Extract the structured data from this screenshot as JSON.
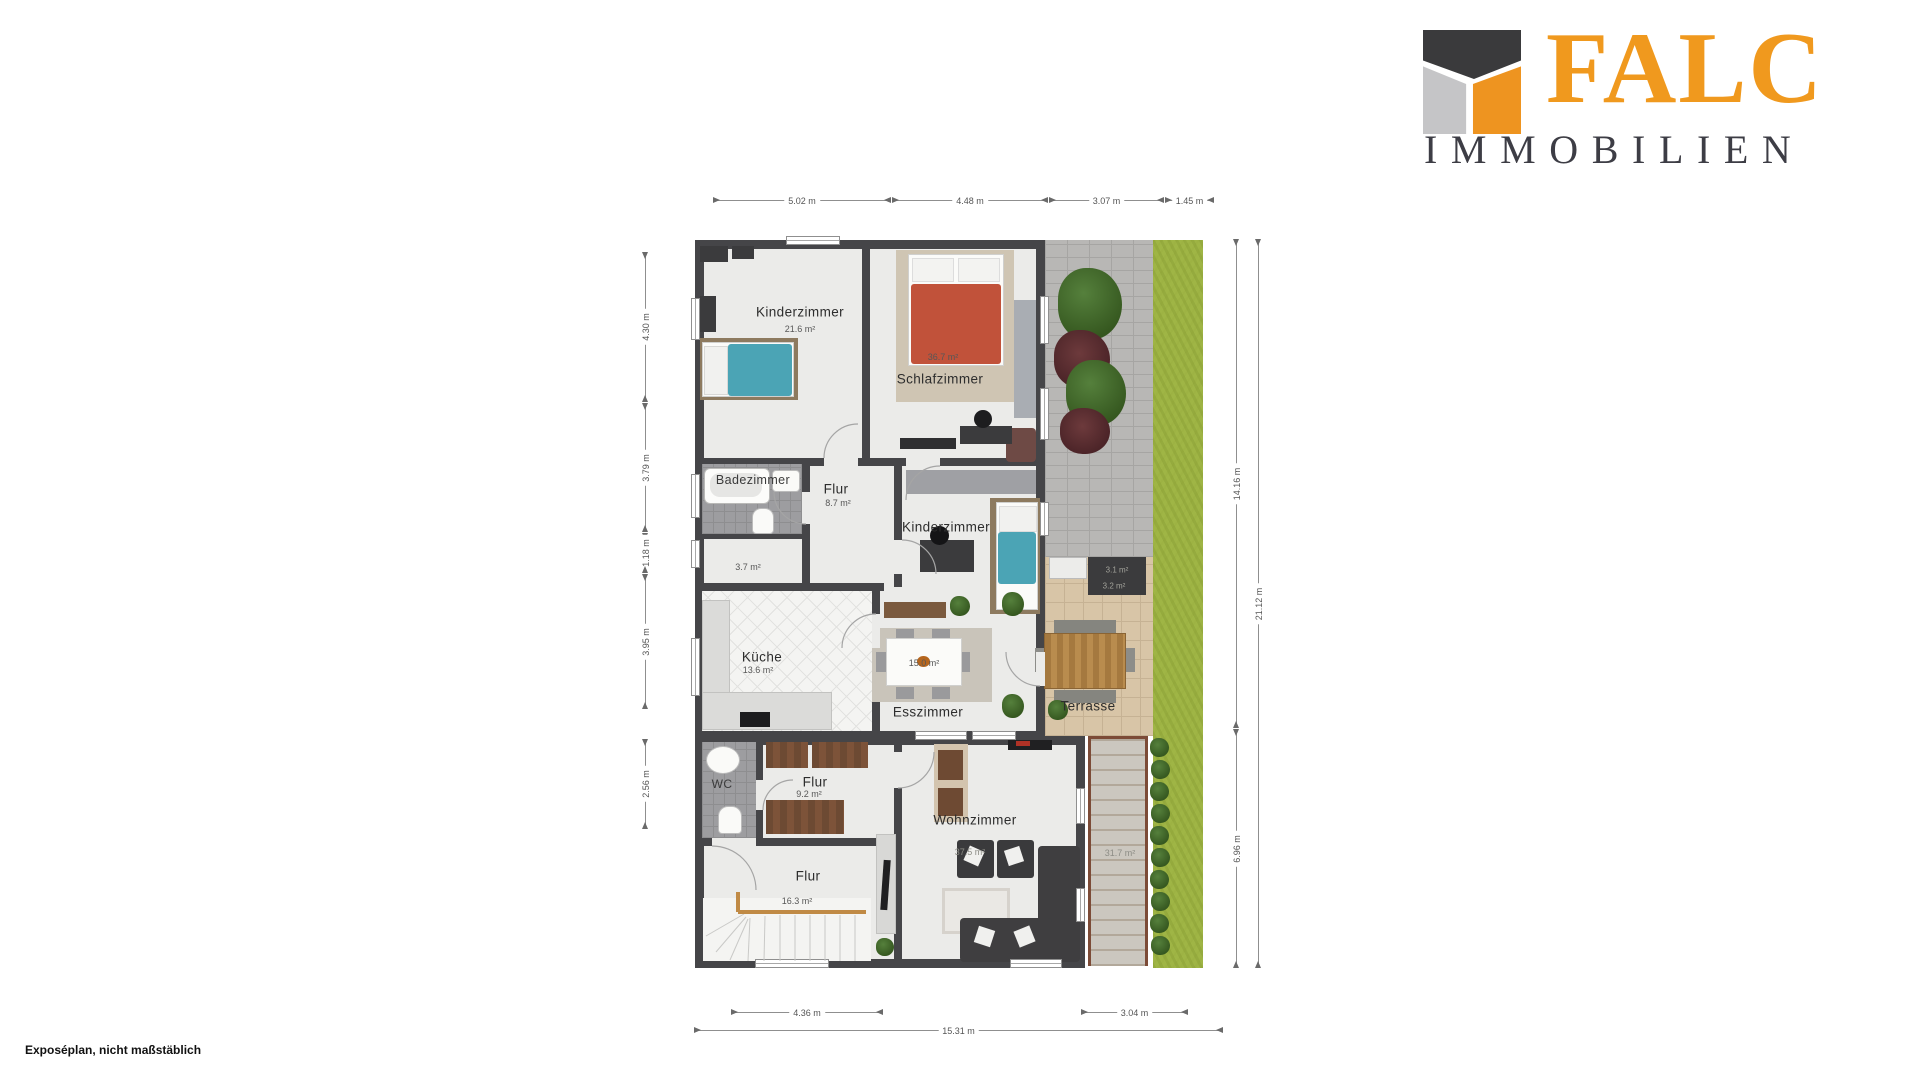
{
  "branding": {
    "name": "FALC",
    "subtitle": "IMMOBILIEN",
    "colors": {
      "orange": "#f0991e",
      "dark": "#3d3d45",
      "gray": "#c5c5c7"
    }
  },
  "footer": {
    "note": "Exposéplan, nicht maßstäblich"
  },
  "plan": {
    "rooms": {
      "kinderzimmer1": {
        "name": "Kinderzimmer",
        "area": "21.6 m²"
      },
      "schlafzimmer": {
        "name": "Schlafzimmer",
        "area": "36.7 m²"
      },
      "badezimmer": {
        "name": "Badezimmer"
      },
      "abstellraum": {
        "area": "3.7 m²"
      },
      "flur1": {
        "name": "Flur",
        "area": "8.7 m²"
      },
      "kinderzimmer2": {
        "name": "Kinderzimmer"
      },
      "kueche": {
        "name": "Küche",
        "area": "13.6 m²"
      },
      "esszimmer": {
        "name": "Esszimmer",
        "area": "15.0 m²"
      },
      "terrasse": {
        "name": "Terrasse"
      },
      "storage_box_top": {
        "area": "3.1 m²"
      },
      "storage_box_bottom": {
        "area": "3.2 m²"
      },
      "wc": {
        "name": "WC"
      },
      "flur2": {
        "name": "Flur",
        "area": "9.2 m²"
      },
      "flur3": {
        "name": "Flur",
        "area": "16.3 m²"
      },
      "wohnzimmer": {
        "name": "Wohnzimmer",
        "area": "37.5 m²"
      },
      "aussenbereich": {
        "area": "31.7 m²"
      }
    },
    "dimensions": {
      "top": [
        "5.02 m",
        "4.48 m",
        "3.07 m",
        "1.45 m"
      ],
      "left": [
        "4.30 m",
        "3.79 m",
        "1.18 m",
        "3.95 m",
        "2.56 m"
      ],
      "right_inner": [
        "14.16 m",
        "6.96 m"
      ],
      "right_outer": "21.12 m",
      "bottom_segments": [
        "4.36 m",
        "3.04 m"
      ],
      "bottom_total": "15.31 m"
    }
  }
}
